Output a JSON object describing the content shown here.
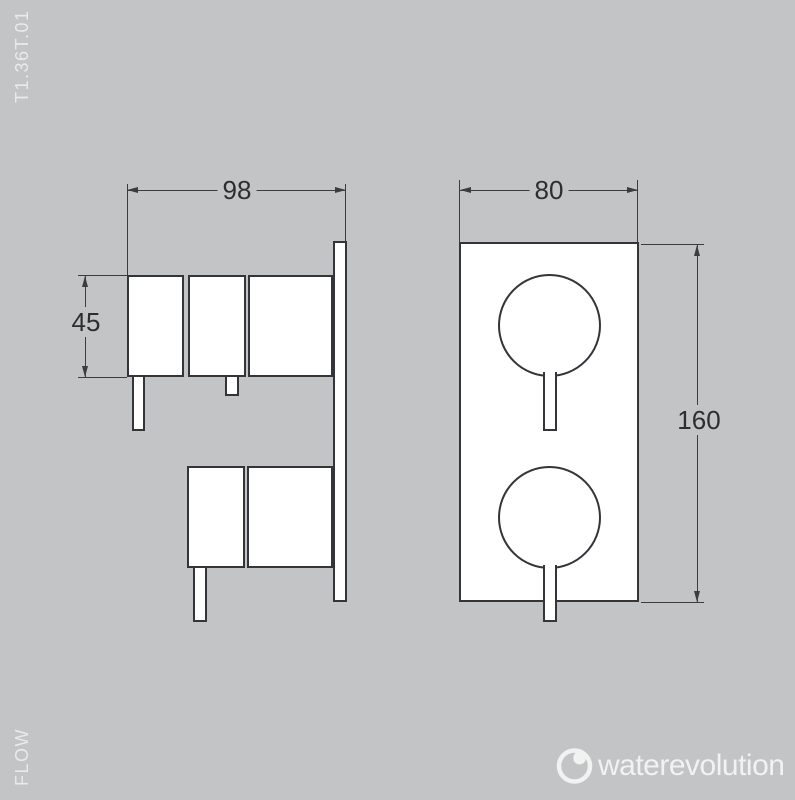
{
  "page": {
    "background_color": "#c2c4c6",
    "line_color": "#3b3c3e",
    "object_fill": "#ffffff"
  },
  "product": {
    "code": "T1.36T.01",
    "series": "FLOW"
  },
  "brand": {
    "name": "waterevolution",
    "icon": "water-drop-ring-icon",
    "color": "#f1f2f2"
  },
  "drawing": {
    "type": "technical-dimension-drawing",
    "subject": "concealed thermostatic mixer valve, side view and front view",
    "views": {
      "side_view": {
        "dimensions": {
          "depth_mm": "98",
          "handle_height_mm": "45"
        }
      },
      "front_view": {
        "dimensions": {
          "plate_width_mm": "80",
          "plate_height_mm": "160"
        }
      }
    }
  }
}
